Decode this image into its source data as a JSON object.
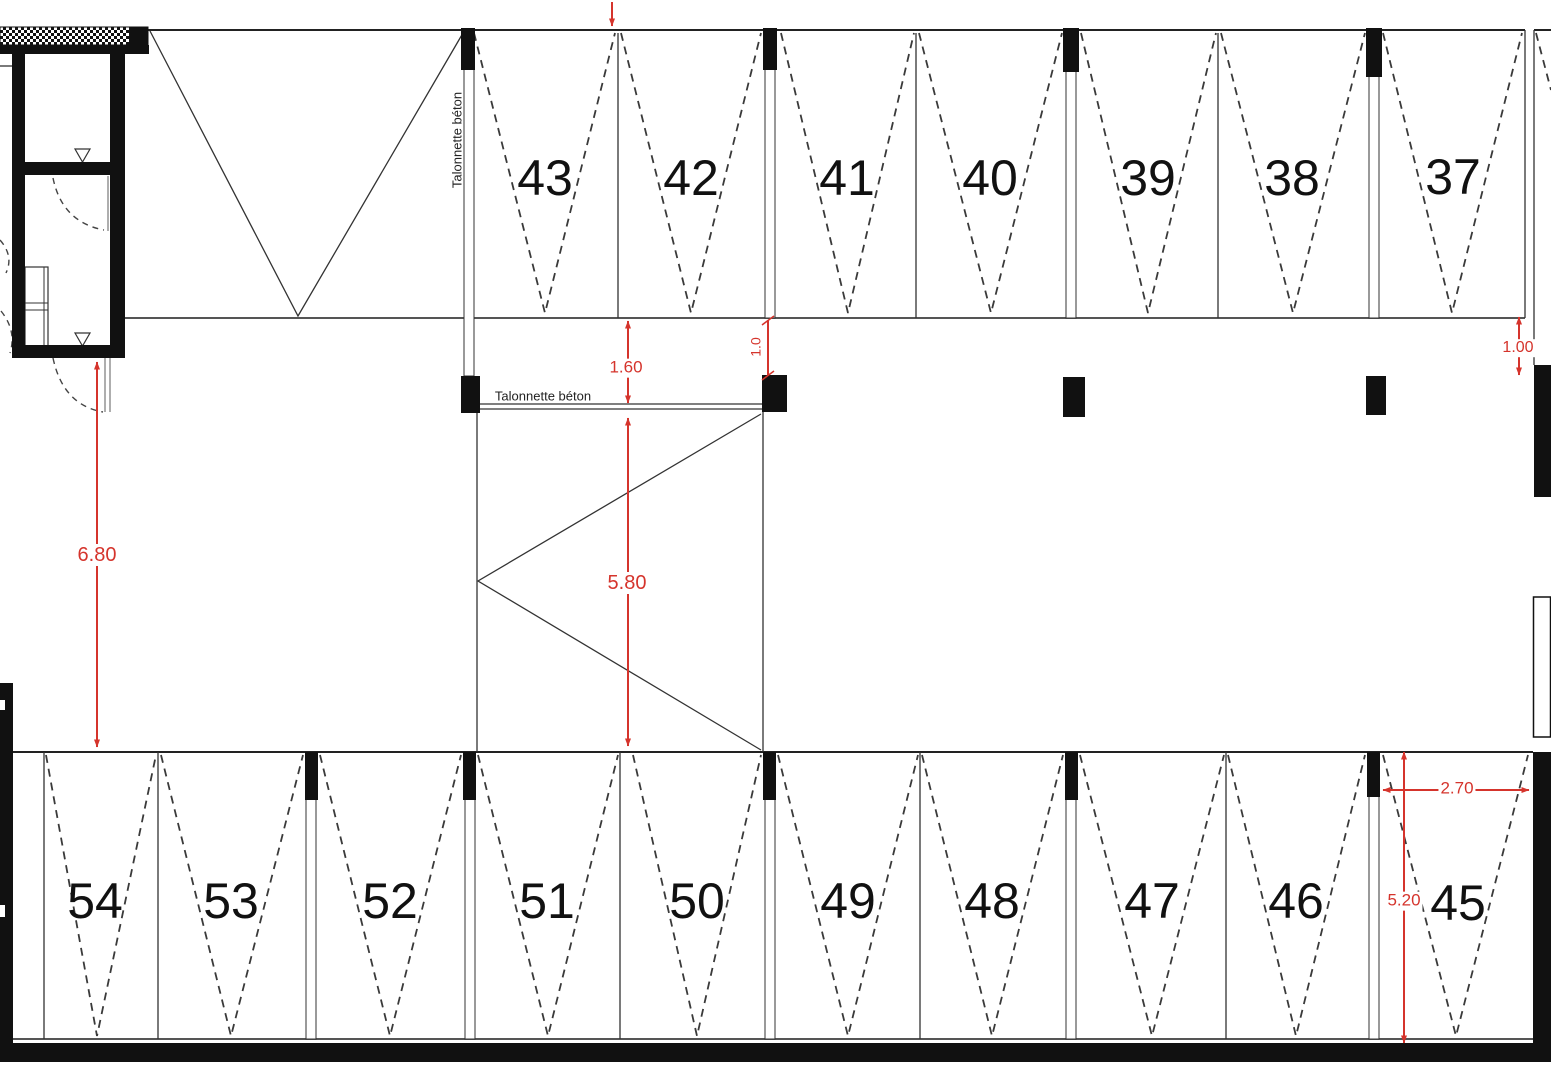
{
  "labels": {
    "talonnette_vertical": "Talonnette béton",
    "talonnette_horizontal": "Talonnette béton"
  },
  "top_row_spaces": [
    "43",
    "42",
    "41",
    "40",
    "39",
    "38",
    "37"
  ],
  "bottom_row_spaces": [
    "54",
    "53",
    "52",
    "51",
    "50",
    "49",
    "48",
    "47",
    "46",
    "45"
  ],
  "dimensions": {
    "aisle_left": "6.80",
    "talonnette_offset": "1.60",
    "bay_depth": "5.80",
    "column_offset": "1.0",
    "right_offset": "1.00",
    "space45_width": "2.70",
    "space45_depth": "5.20"
  },
  "colors": {
    "dimension_red": "#d5342c",
    "line_black": "#111111"
  }
}
